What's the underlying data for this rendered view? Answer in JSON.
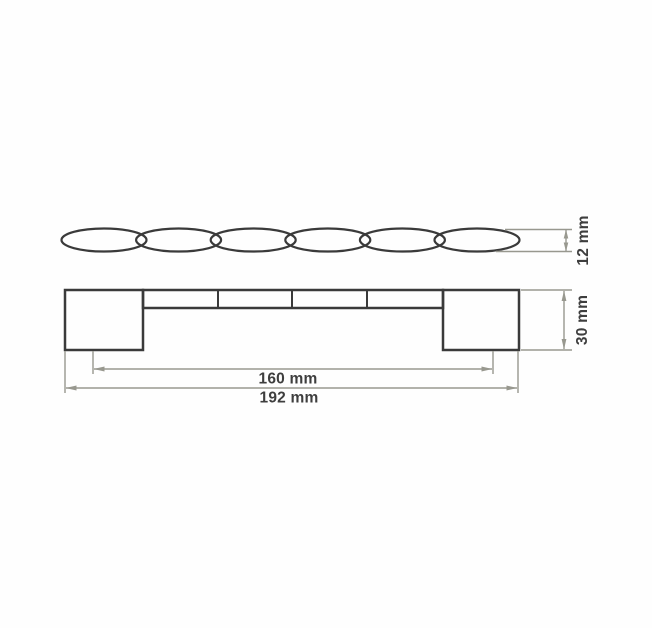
{
  "figure": {
    "kind": "technical-drawing",
    "background": "#fefefe"
  },
  "colors": {
    "outline": "#3a3a3a",
    "dimension_lines": "#98988f",
    "label_text": "#3e3e3e"
  },
  "top_view": {
    "description": "scalloped profile of handle (top view)",
    "scallop_count": 6
  },
  "front_view": {
    "description": "front elevation of handle with two mounting feet",
    "bar_divider_count": 3
  },
  "dimensions": {
    "profile_height": "12 mm",
    "front_height": "30 mm",
    "hole_spacing": "160 mm",
    "overall_width": "192 mm"
  }
}
